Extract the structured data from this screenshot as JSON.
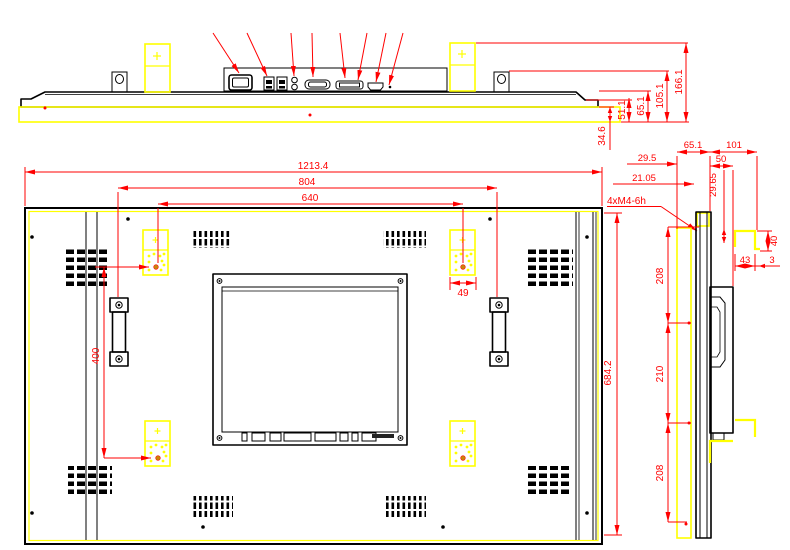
{
  "colors": {
    "dimension_red": "#ff0000",
    "highlight_yellow": "#ffff00",
    "outline_black": "#000000",
    "mount_hole_gold": "#c8860a"
  },
  "top_view": {
    "dims": {
      "overall": "166.1",
      "bracket": "105.1",
      "body": "65.1",
      "step": "51.1",
      "glass": "34.6"
    }
  },
  "back_view": {
    "dims": {
      "width": "1213.4",
      "handle_span": "804",
      "mount_span_h": "640",
      "mount_span_v": "400",
      "height": "684.2",
      "pad_width": "49"
    },
    "thread_note": "4xM4-6h"
  },
  "side_view": {
    "dims": {
      "depth_body": "65.1",
      "depth_mount": "101",
      "d29_5": "29.5",
      "d50": "50",
      "d21_05": "21.05",
      "d29_65": "29.65",
      "seg_top": "208",
      "seg_mid": "210",
      "seg_bot": "208",
      "bracket_w": "43",
      "bracket_t": "3",
      "bracket_h": "40"
    }
  }
}
